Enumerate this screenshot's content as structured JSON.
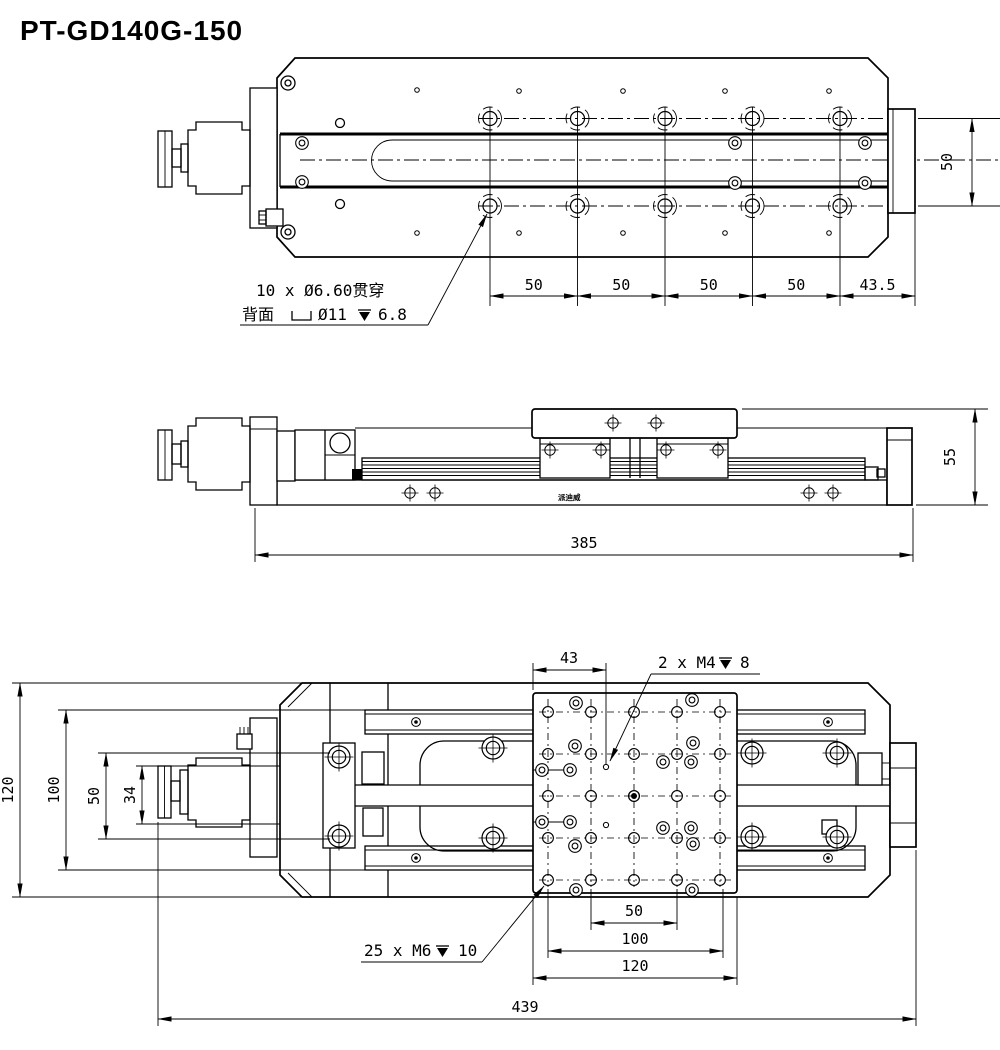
{
  "title": "PT-GD140G-150",
  "colors": {
    "line": "#000000",
    "background": "#ffffff"
  },
  "top_view": {
    "hole_note_line1": "10 x Ø6.60贯穿",
    "hole_note_back_label": "背面",
    "hole_note_cbore": "Ø11",
    "hole_note_cbore_depth": "6.8",
    "pitch_dims": [
      "50",
      "50",
      "50",
      "50",
      "43.5"
    ],
    "table_width_dim": "50"
  },
  "side_view": {
    "length_dim": "385",
    "height_dim": "55",
    "brand_text": "派迪威"
  },
  "bottom_view": {
    "platform_offset_dim": "43",
    "m4_note_count": "2 x M4",
    "m4_note_depth": "8",
    "m6_note_count": "25 x M6",
    "m6_note_depth": "10",
    "left_dims": [
      "120",
      "100",
      "50",
      "34"
    ],
    "bottom_dims": [
      "50",
      "100",
      "120",
      "439"
    ]
  }
}
